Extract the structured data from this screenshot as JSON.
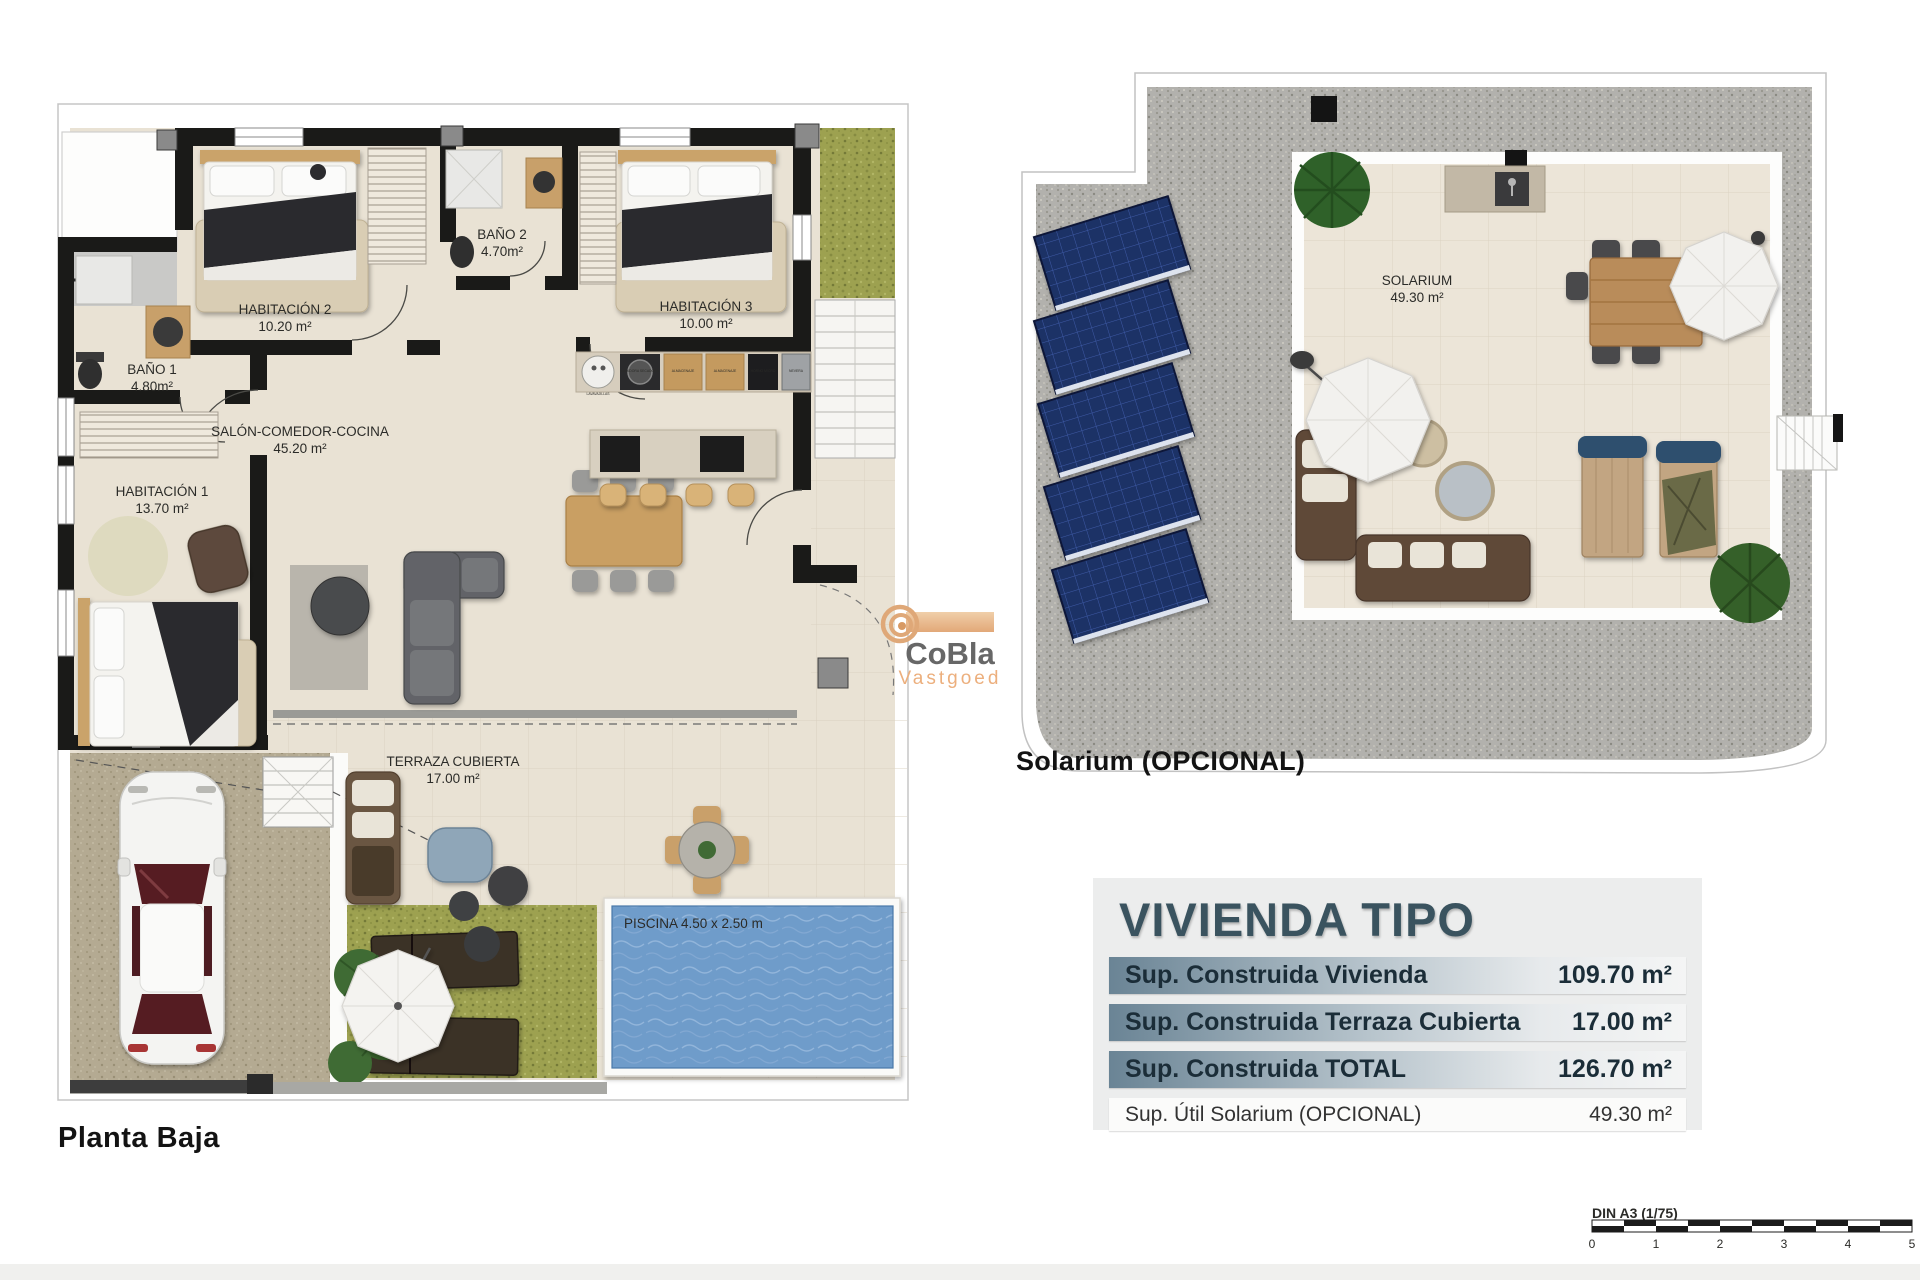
{
  "planta_baja": {
    "caption": "Planta Baja",
    "rooms": {
      "habitacion2": {
        "name": "HABITACIÓN 2",
        "area": "10.20 m²"
      },
      "bano2": {
        "name": "BAÑO 2",
        "area": "4.70m²"
      },
      "habitacion3": {
        "name": "HABITACIÓN 3",
        "area": "10.00 m²"
      },
      "bano1": {
        "name": "BAÑO 1",
        "area": "4.80m²"
      },
      "habitacion1": {
        "name": "HABITACIÓN 1",
        "area": "13.70 m²"
      },
      "salon": {
        "name": "SALÓN-COMEDOR-COCINA",
        "area": "45.20 m²"
      },
      "terraza": {
        "name": "TERRAZA CUBIERTA",
        "area": "17.00 m²"
      }
    },
    "pool_label": "PISCINA 4.50 x 2.50 m",
    "kitchen_units": [
      "LAVAVAJILLAS",
      "LAVADORA SECADORA",
      "ALMACENAJE",
      "ALMACENAJE",
      "HORNO MICRO",
      "NEVERA"
    ]
  },
  "solarium_plan": {
    "caption": "Solarium (OPCIONAL)",
    "room": {
      "name": "SOLARIUM",
      "area": "49.30 m²"
    }
  },
  "summary": {
    "title": "VIVIENDA TIPO",
    "rows": [
      {
        "label": "Sup. Construida Vivienda",
        "value": "109.70 m²"
      },
      {
        "label": "Sup. Construida Terraza Cubierta",
        "value": "17.00 m²"
      },
      {
        "label": "Sup. Construida TOTAL",
        "value": "126.70 m²"
      },
      {
        "label": "Sup. Útil Solarium (OPCIONAL)",
        "value": "49.30 m²"
      }
    ]
  },
  "logo": {
    "name": "CoBla",
    "sub": "Vastgoed"
  },
  "scalebar": {
    "label": "DIN A3 (1/75)",
    "ticks": [
      "0",
      "1",
      "2",
      "3",
      "4",
      "5"
    ]
  },
  "colors": {
    "accent": "#3a535f",
    "row_gradient": "#6a8495",
    "logo_tan": "#e2a878",
    "pool": "#6f9cca",
    "wall": "#1a1a18",
    "floor": "#e9e2d4"
  }
}
